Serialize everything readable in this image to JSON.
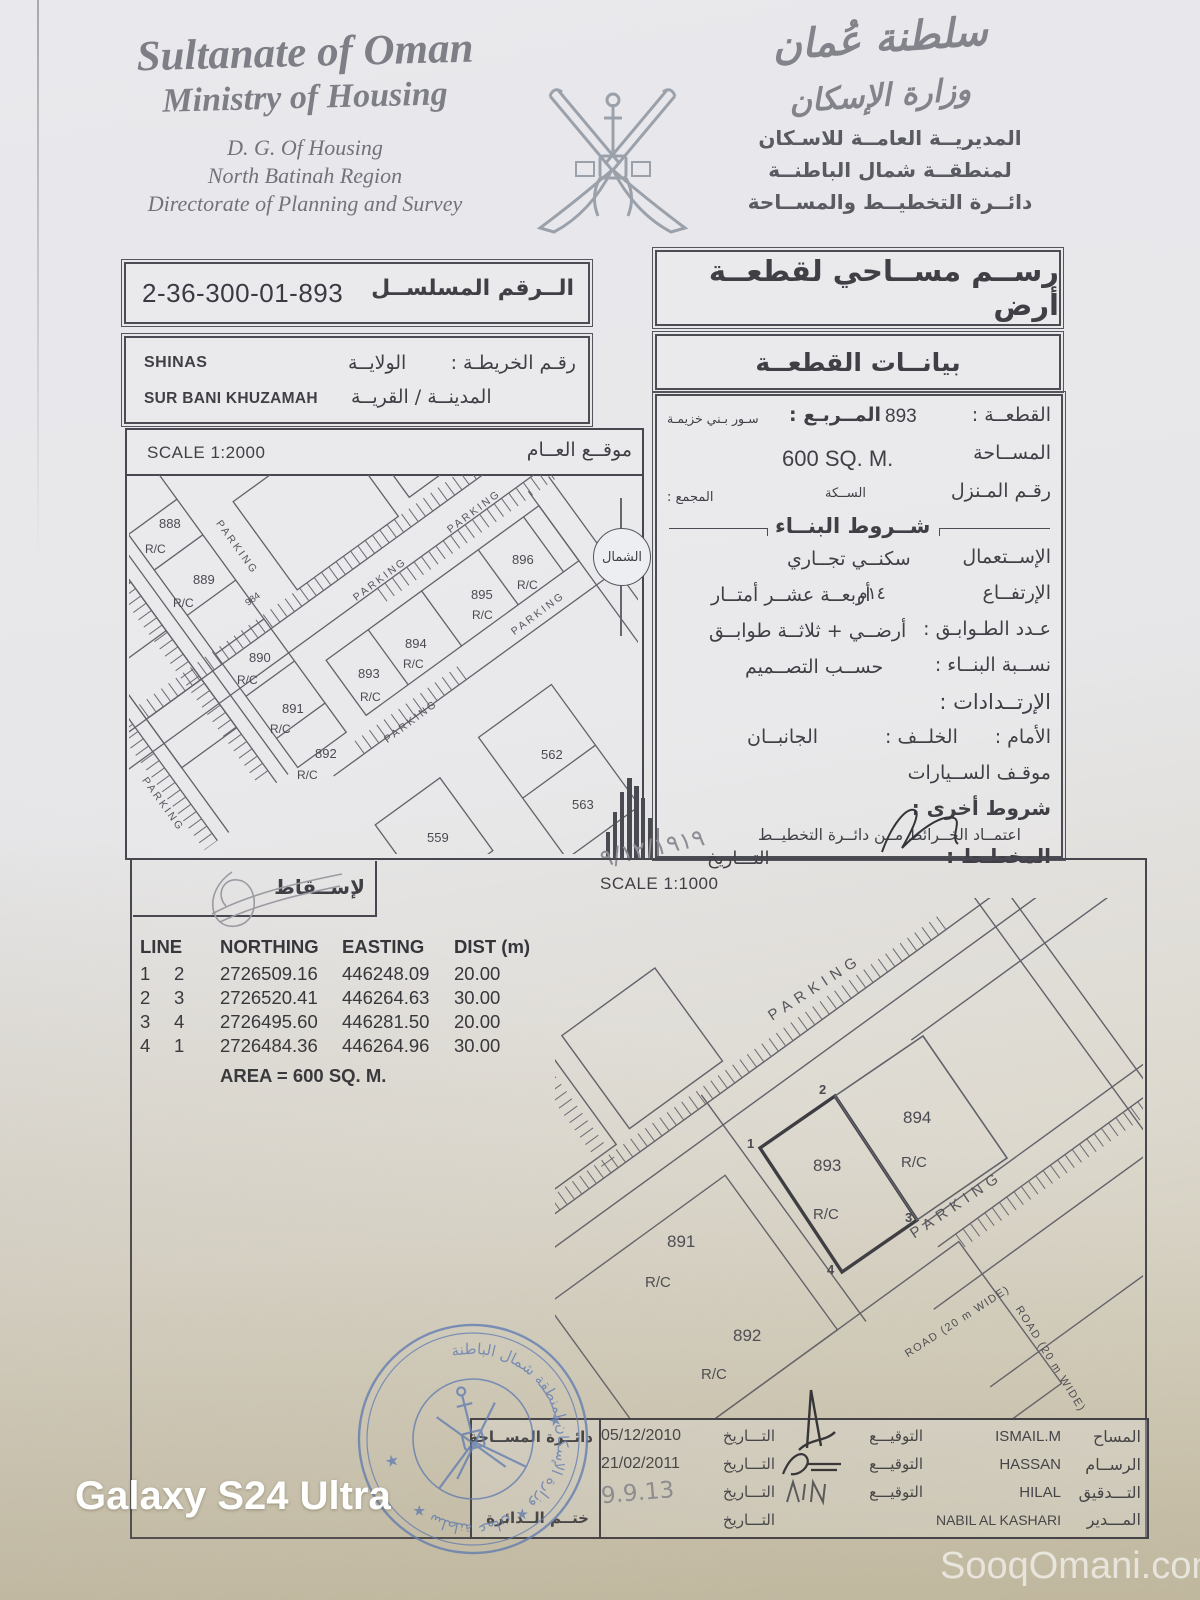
{
  "watermarks": {
    "device": "Galaxy S24 Ultra",
    "site": "SooqOmani.com"
  },
  "header_en": {
    "l1": "Sultanate of Oman",
    "l2": "Ministry of Housing",
    "l3": "D. G. Of Housing",
    "l4": "North Batinah Region",
    "l5": "Directorate of Planning and Survey"
  },
  "header_ar": {
    "callig1": "سلطنة عُمان",
    "callig2": "وزارة الإسكان",
    "l1": "المديريــة العامــة للاسـكان",
    "l2": "لمنطقــة شمال الباطنــة",
    "l3": "دائــرة التخطيــط والمســاحة"
  },
  "serial": {
    "label": "الــرقم المسلســل",
    "value": "2-36-300-01-893"
  },
  "location": {
    "map_no": "رقـم الخريطـة :",
    "wilaya_label": "الولايــة",
    "wilaya_value": "SHINAS",
    "town_label": "المدينــة / القريــة",
    "town_value": "SUR BANI KHUZAMAH"
  },
  "title_box": "رســم مســاحي لقطعــة أرض",
  "data_title": "بيانــات القطعــة",
  "plot": {
    "plot_label": "القطعــة :",
    "plot_value": "893",
    "square_label": "المــربـع :",
    "square_value": "سـور بـني خزيمـة",
    "area_label": "المســاحة",
    "area_value": "600 SQ. M.",
    "house_label": "رقـم المـنزل",
    "street_label": "الســكة",
    "complex_label": "المجمع :",
    "conditions_title": "شــروط البنــاء",
    "use_label": "الإســتعمال",
    "use_value": "سكنــي تجــاري",
    "height_label": "الإرتفــاع",
    "height_num": "١٤م",
    "height_value": "أربعــة عشــر أمتــار",
    "floors_label": "عـدد الطـوابـق :",
    "floors_value": "أرضــي + ثلاثــة طوابــق",
    "ratio_label": "نســبة البنــاء :",
    "ratio_value": "حســب التصــميم",
    "setbacks_label": "الإرتــدادات :",
    "front_label": "الأمام :",
    "back_label": "الخلــف :",
    "sides_label": "الجانبــان",
    "parking_label": "موقـف الســيارات",
    "other_label": "شروط أخرى :",
    "approval_line": "اعتمــاد الخــرائط مــن دائــرة التخطيــط",
    "planner_label": "المخطـط :",
    "date_label": "التـــاريخ",
    "planner_date": "٩/١٢/١٩١٩"
  },
  "overview": {
    "scale": "SCALE 1:2000",
    "title": "موقــع العــام",
    "north": "الشمال",
    "parking": "PARKING",
    "rc": "R/C",
    "plots": {
      "p888": "888",
      "p889": "889",
      "p984": "984",
      "p890": "890",
      "p891": "891",
      "p892": "892",
      "p893": "893",
      "p894": "894",
      "p895": "895",
      "p896": "896",
      "p562": "562",
      "p563": "563",
      "p559": "559"
    }
  },
  "projection": {
    "header": "لإســقاط",
    "scale": "SCALE 1:1000",
    "cols": {
      "line": "LINE",
      "northing": "NORTHING",
      "easting": "EASTING",
      "dist": "DIST (m)"
    },
    "rows": [
      {
        "a": "1",
        "b": "2",
        "n": "2726509.16",
        "e": "446248.09",
        "d": "20.00"
      },
      {
        "a": "2",
        "b": "3",
        "n": "2726520.41",
        "e": "446264.63",
        "d": "30.00"
      },
      {
        "a": "3",
        "b": "4",
        "n": "2726495.60",
        "e": "446281.50",
        "d": "20.00"
      },
      {
        "a": "4",
        "b": "1",
        "n": "2726484.36",
        "e": "446264.96",
        "d": "30.00"
      }
    ],
    "area": "AREA = 600 SQ. M."
  },
  "detail": {
    "parking": "PARKING",
    "road": "ROAD (20 m WIDE)",
    "road2": "ROAD (20 m WIDE)",
    "rc": "R/C",
    "plots": {
      "p893": "893",
      "p894": "894",
      "p891": "891",
      "p892": "892"
    },
    "corners": {
      "c1": "1",
      "c2": "2",
      "c3": "3",
      "c4": "4"
    }
  },
  "sign_table": {
    "stamp_top": "دائــرة المســاحة",
    "stamp_bottom": "ختــم الــدائرة",
    "rows": [
      {
        "role": "المساح",
        "name": "ISMAIL.M",
        "sig": "التوقيـــع",
        "datel": "التـــاريخ",
        "date": "05/12/2010"
      },
      {
        "role": "الرســام",
        "name": "HASSAN",
        "sig": "التوقيـــع",
        "datel": "التـــاريخ",
        "date": "21/02/2011"
      },
      {
        "role": "التـــدقيق",
        "name": "HILAL",
        "sig": "التوقيـــع",
        "datel": "التـــاريخ",
        "date": "9.9.13"
      },
      {
        "role": "المـــدير",
        "name": "NABIL AL KASHARI",
        "sig": "",
        "datel": "التـــاريخ",
        "date": ""
      }
    ]
  },
  "stamp": {
    "ring": "سلطنة عمان ★ وزارة الإسكان لمنطقة شمال الباطنة ★",
    "color": "#5f7fbe"
  }
}
